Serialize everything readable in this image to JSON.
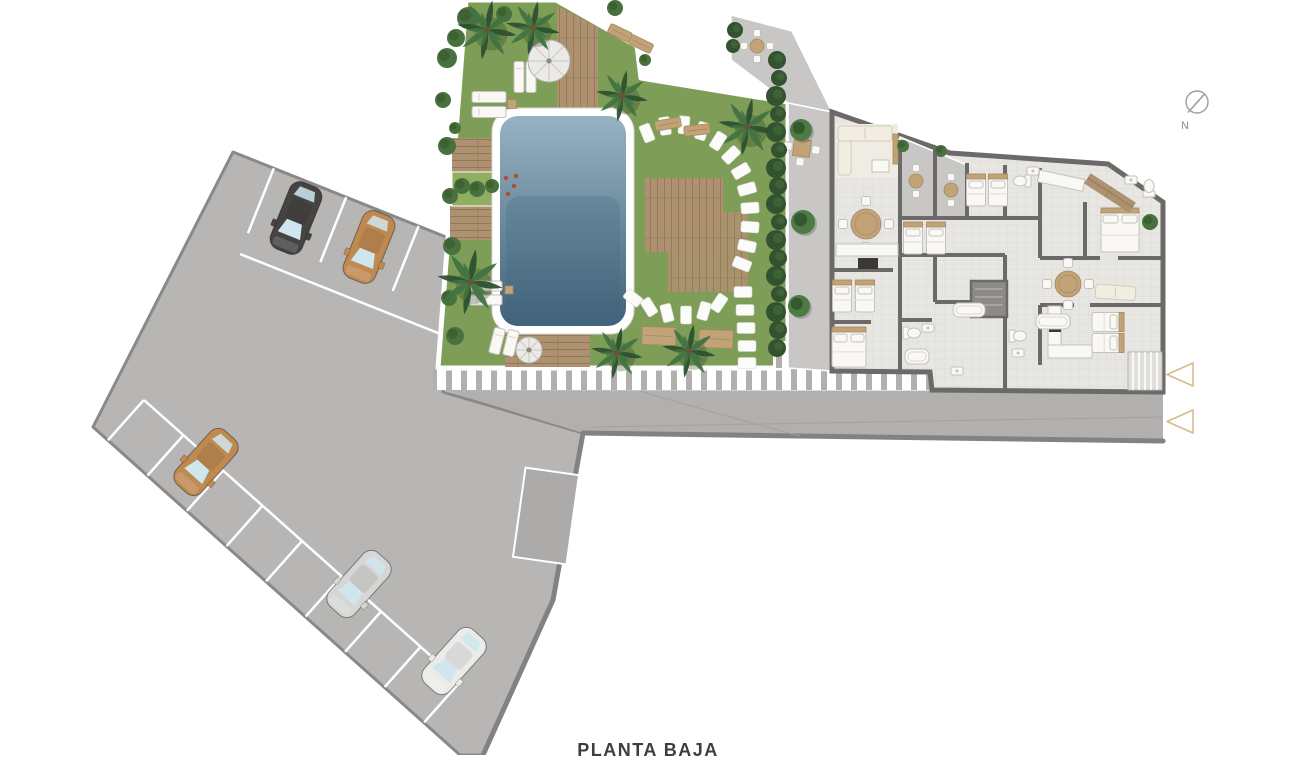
{
  "title": "PLANTA BAJA",
  "compass": {
    "label": "N"
  },
  "colors": {
    "page_bg": "#ffffff",
    "parking": "#b8b6b4",
    "parking_border": "#8b8987",
    "space": "#adabaa",
    "road": "#b2b0ae",
    "curb": "#848280",
    "road_line": "#a3a19f",
    "lawn": "#7e9e57",
    "deck": "#ad9170",
    "deck_line": "#937857",
    "pool_light": "#96b3c2",
    "pool_dark": "#40627a",
    "stone": "#fbfbf9",
    "planter": "#8fae62",
    "flower": "#b34a38",
    "palm_dark": "#2c5130",
    "palm_mid": "#427342",
    "bush": "#49713f",
    "bush_dark": "#335427",
    "hedge": "#33522f",
    "floor": "#e7e6e2",
    "grid": "#dbdad5",
    "wall": "#6c6a68",
    "terrace": "#c8c7c5",
    "core": "#8d8b89",
    "stair": "#e0dfdb",
    "furn_white": "#f9f8f5",
    "furn_stroke": "#c4c2bc",
    "tan": "#c2a277",
    "tan_dark": "#a5895f",
    "appliance": "#3a3938",
    "rug": "#efece4",
    "arrow": "#d9ba8a",
    "compass": "#a09e9c",
    "text": "#3f3e3d",
    "glass": "#cfe6ee"
  },
  "parking": {
    "cars": [
      {
        "name": "black-car",
        "x": 296,
        "y": 218,
        "rot": 202,
        "body": "#454443"
      },
      {
        "name": "tan-car",
        "x": 369,
        "y": 247,
        "rot": 202,
        "body": "#bf8952"
      },
      {
        "name": "tan-car",
        "x": 206,
        "y": 462,
        "rot": 222,
        "body": "#bf8952"
      },
      {
        "name": "silver-car",
        "x": 359,
        "y": 584,
        "rot": 222,
        "body": "#d6d6d4"
      },
      {
        "name": "white-car",
        "x": 454,
        "y": 661,
        "rot": 222,
        "body": "#ebebe9"
      }
    ],
    "stripe_rows": [
      {
        "origin": [
          233,
          152
        ],
        "dir": [
          0.928,
          0.37
        ],
        "normal": [
          -0.37,
          0.928
        ],
        "ticks": [
          44,
          122,
          200
        ],
        "tick_len": 70,
        "lane_line": {
          "from": [
            240,
            254
          ],
          "to": [
            443,
            335
          ]
        }
      },
      {
        "origin": [
          93,
          427
        ],
        "dir": [
          0.746,
          0.665
        ],
        "normal": [
          0.665,
          -0.746
        ],
        "ticks": [
          20,
          73,
          126,
          179,
          232,
          285,
          338,
          391,
          444
        ],
        "tick_len": 54,
        "lane_line": {
          "from": [
            144,
            400
          ],
          "to": [
            450,
            673
          ]
        }
      }
    ],
    "marked_space": {
      "x": 546,
      "y": 516,
      "w": 54,
      "h": 90,
      "rot": 8
    }
  },
  "garden": {
    "palms": [
      [
        487,
        30,
        30
      ],
      [
        533,
        28,
        27
      ],
      [
        622,
        96,
        26
      ],
      [
        747,
        127,
        29
      ],
      [
        470,
        282,
        33
      ],
      [
        617,
        353,
        26
      ],
      [
        689,
        351,
        27
      ]
    ],
    "bushes": [
      [
        447,
        58,
        10
      ],
      [
        443,
        100,
        8
      ],
      [
        447,
        146,
        9
      ],
      [
        450,
        196,
        8
      ],
      [
        452,
        246,
        9
      ],
      [
        449,
        298,
        8
      ],
      [
        455,
        336,
        9
      ],
      [
        468,
        18,
        11
      ],
      [
        456,
        38,
        9
      ],
      [
        504,
        14,
        8
      ],
      [
        615,
        8,
        8
      ],
      [
        462,
        186,
        8
      ],
      [
        477,
        189,
        8
      ],
      [
        492,
        186,
        7
      ],
      [
        455,
        128,
        6
      ],
      [
        645,
        60,
        6
      ],
      [
        903,
        146,
        6
      ],
      [
        941,
        151,
        6
      ],
      [
        1150,
        222,
        8
      ]
    ],
    "flowers": [
      [
        506,
        178
      ],
      [
        514,
        186
      ],
      [
        508,
        194
      ],
      [
        516,
        176
      ]
    ],
    "stones": [
      [
        647,
        133,
        -22
      ],
      [
        665,
        126,
        -8
      ],
      [
        684,
        125,
        4
      ],
      [
        702,
        131,
        18
      ],
      [
        718,
        141,
        32
      ],
      [
        731,
        155,
        46
      ],
      [
        741,
        171,
        60
      ],
      [
        747,
        189,
        74
      ],
      [
        750,
        208,
        86
      ],
      [
        750,
        227,
        94
      ],
      [
        747,
        246,
        102
      ],
      [
        742,
        264,
        112
      ],
      [
        743,
        292,
        90
      ],
      [
        745,
        310,
        90
      ],
      [
        746,
        328,
        90
      ],
      [
        747,
        346,
        90
      ],
      [
        747,
        363,
        90
      ],
      [
        633,
        298,
        -52
      ],
      [
        649,
        307,
        -32
      ],
      [
        667,
        313,
        -14
      ],
      [
        686,
        315,
        0
      ],
      [
        704,
        311,
        16
      ],
      [
        719,
        303,
        34
      ]
    ],
    "loungers": [
      {
        "x": 519,
        "y": 77,
        "w": 10,
        "h": 31,
        "rot": 0
      },
      {
        "x": 531,
        "y": 77,
        "w": 10,
        "h": 31,
        "rot": 0
      },
      {
        "x": 489,
        "y": 97,
        "w": 34,
        "h": 11,
        "rot": 0
      },
      {
        "x": 489,
        "y": 112,
        "w": 34,
        "h": 11,
        "rot": 0
      },
      {
        "x": 486,
        "y": 286,
        "w": 32,
        "h": 10,
        "rot": 0
      },
      {
        "x": 486,
        "y": 300,
        "w": 32,
        "h": 10,
        "rot": 0
      },
      {
        "x": 497,
        "y": 341,
        "w": 11,
        "h": 26,
        "rot": 14
      },
      {
        "x": 511,
        "y": 343,
        "w": 11,
        "h": 26,
        "rot": 14
      }
    ],
    "side_tables": [
      {
        "x": 512,
        "y": 104,
        "w": 9,
        "h": 9
      },
      {
        "x": 509,
        "y": 290,
        "w": 8,
        "h": 8
      }
    ],
    "parasols": [
      {
        "x": 549,
        "y": 61,
        "r": 21
      },
      {
        "x": 529,
        "y": 350,
        "r": 13
      }
    ],
    "benches": [
      {
        "x": 620,
        "y": 33,
        "w": 24,
        "h": 10,
        "rot": 26
      },
      {
        "x": 641,
        "y": 44,
        "w": 24,
        "h": 10,
        "rot": 26
      },
      {
        "x": 668,
        "y": 124,
        "w": 26,
        "h": 10,
        "rot": -10
      },
      {
        "x": 697,
        "y": 130,
        "w": 26,
        "h": 10,
        "rot": -6
      },
      {
        "x": 659,
        "y": 336,
        "w": 34,
        "h": 18,
        "rot": 2
      },
      {
        "x": 716,
        "y": 339,
        "w": 34,
        "h": 18,
        "rot": 2
      }
    ]
  },
  "terrace": {
    "hedge": [
      [
        777,
        60,
        9
      ],
      [
        779,
        78,
        8
      ],
      [
        776,
        96,
        10
      ],
      [
        778,
        114,
        8
      ],
      [
        776,
        132,
        10
      ],
      [
        779,
        150,
        8
      ],
      [
        776,
        168,
        10
      ],
      [
        778,
        186,
        9
      ],
      [
        776,
        204,
        10
      ],
      [
        779,
        222,
        8
      ],
      [
        776,
        240,
        10
      ],
      [
        778,
        258,
        9
      ],
      [
        776,
        276,
        10
      ],
      [
        779,
        294,
        8
      ],
      [
        776,
        312,
        10
      ],
      [
        778,
        330,
        9
      ],
      [
        777,
        348,
        9
      ],
      [
        735,
        30,
        8
      ],
      [
        733,
        46,
        7
      ]
    ],
    "trees": [
      [
        801,
        130,
        11
      ],
      [
        803,
        222,
        12
      ],
      [
        799,
        306,
        11
      ]
    ]
  },
  "building": {
    "furniture": {
      "beds_double": [
        {
          "x": 849,
          "y": 347,
          "w": 34,
          "h": 40,
          "rot": 0
        },
        {
          "x": 1120,
          "y": 230,
          "w": 38,
          "h": 44,
          "rot": 0
        }
      ],
      "beds_single": [
        {
          "x": 842,
          "y": 296,
          "rot": 0
        },
        {
          "x": 865,
          "y": 296,
          "rot": 0
        },
        {
          "x": 976,
          "y": 190,
          "rot": 0
        },
        {
          "x": 998,
          "y": 190,
          "rot": 0
        },
        {
          "x": 913,
          "y": 238,
          "rot": 0
        },
        {
          "x": 936,
          "y": 238,
          "rot": 0
        },
        {
          "x": 1108,
          "y": 322,
          "rot": 90
        },
        {
          "x": 1108,
          "y": 343,
          "rot": 90
        }
      ],
      "round_tables": [
        {
          "x": 866,
          "y": 224,
          "r": 15,
          "chairs": 4
        },
        {
          "x": 1068,
          "y": 284,
          "r": 13,
          "chairs": 4
        }
      ],
      "bistro_tables": [
        {
          "x": 916,
          "y": 181,
          "chairs": 2
        },
        {
          "x": 951,
          "y": 190,
          "chairs": 2
        },
        {
          "x": 757,
          "y": 46,
          "chairs": 4
        }
      ],
      "square_table_sets": [
        {
          "x": 802,
          "y": 148
        }
      ],
      "sofas": [
        {
          "x": 838,
          "y": 126,
          "w": 54,
          "h": 15,
          "rot": 0
        },
        {
          "x": 838,
          "y": 141,
          "w": 13,
          "h": 34,
          "rot": 0
        },
        {
          "x": 1096,
          "y": 284,
          "w": 40,
          "h": 14,
          "rot": 4
        }
      ],
      "coffee_tables": [
        {
          "x": 872,
          "y": 160,
          "w": 17,
          "h": 12
        }
      ],
      "tv_units": [
        {
          "x": 893,
          "y": 134,
          "w": 5,
          "h": 30
        }
      ],
      "counters": [
        {
          "x": 836,
          "y": 244,
          "w": 62,
          "h": 12,
          "rot": 0
        },
        {
          "x": 1048,
          "y": 306,
          "w": 13,
          "h": 52,
          "rot": 0
        },
        {
          "x": 1048,
          "y": 345,
          "w": 44,
          "h": 13,
          "rot": 0
        },
        {
          "x": 1040,
          "y": 170,
          "w": 46,
          "h": 12,
          "rot": 12
        }
      ],
      "appliances": [
        {
          "x": 858,
          "y": 258,
          "w": 20,
          "h": 11
        },
        {
          "x": 1049,
          "y": 320,
          "w": 12,
          "h": 12
        }
      ],
      "tubs": [
        {
          "x": 953,
          "y": 303,
          "w": 32,
          "h": 14
        },
        {
          "x": 1036,
          "y": 314,
          "w": 34,
          "h": 15
        },
        {
          "x": 905,
          "y": 349,
          "w": 24,
          "h": 15
        }
      ],
      "toilets": [
        {
          "x": 912,
          "y": 333,
          "rot": -90
        },
        {
          "x": 1022,
          "y": 181,
          "rot": 90
        },
        {
          "x": 1149,
          "y": 188,
          "rot": 180
        },
        {
          "x": 1018,
          "y": 336,
          "rot": -90
        }
      ],
      "sinks": [
        {
          "x": 928,
          "y": 328
        },
        {
          "x": 1033,
          "y": 171
        },
        {
          "x": 1131,
          "y": 180
        },
        {
          "x": 1018,
          "y": 353
        },
        {
          "x": 957,
          "y": 371
        }
      ],
      "deck_strip": {
        "x": 1110,
        "y": 193,
        "w": 54,
        "h": 12,
        "rot": 33
      }
    }
  },
  "entrance_arrows": [
    {
      "x": 1167,
      "y": 363
    },
    {
      "x": 1167,
      "y": 410
    }
  ]
}
